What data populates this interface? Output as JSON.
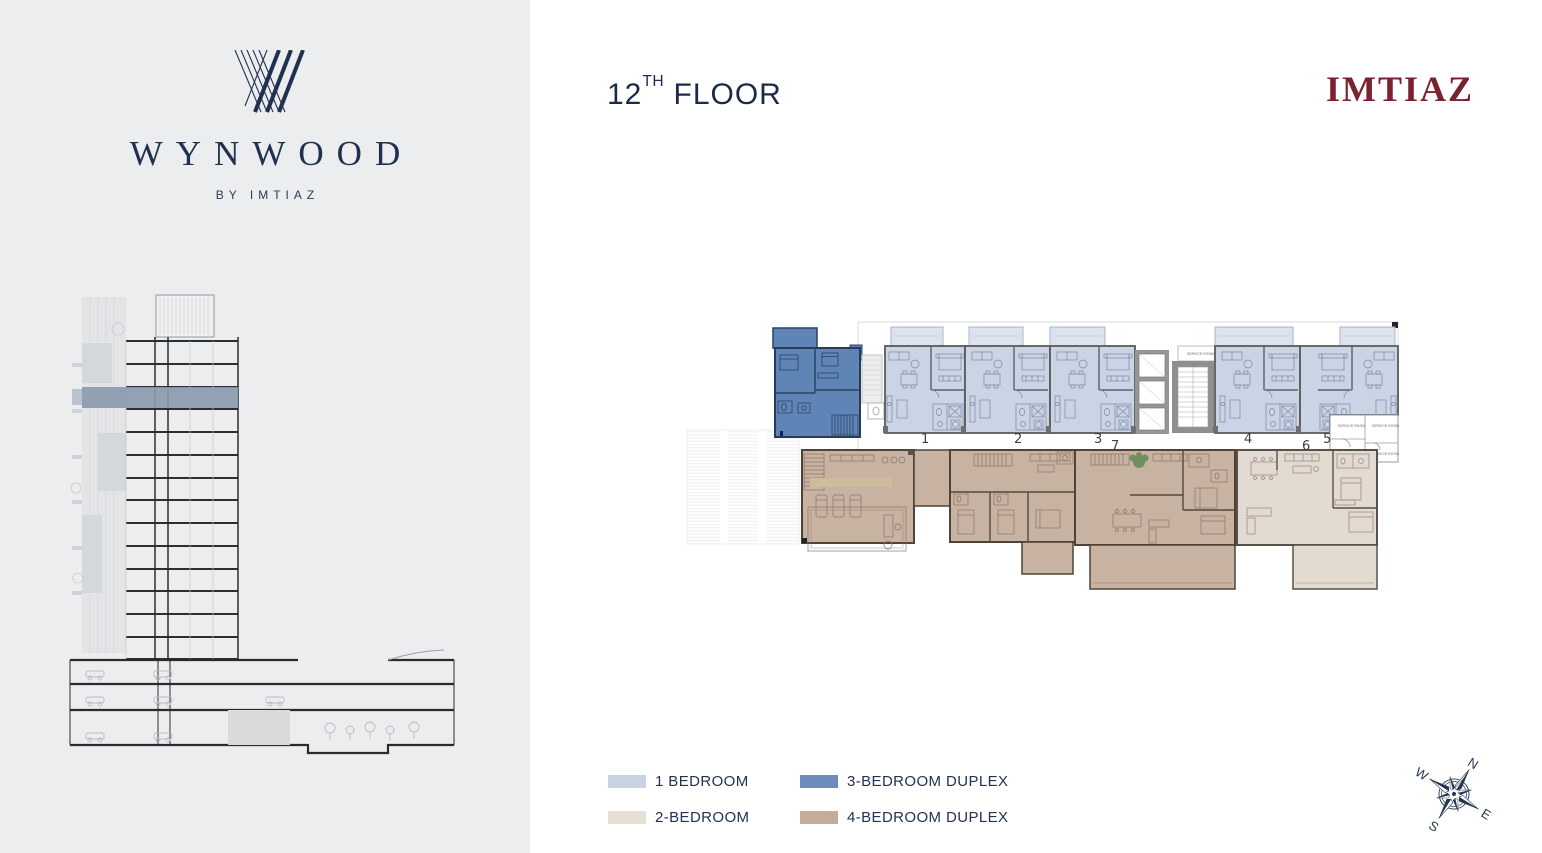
{
  "brand_panel": {
    "logo_word": "WYNWOOD",
    "logo_byline": "BY IMTIAZ"
  },
  "header": {
    "floor_main": "12",
    "floor_sup": "TH",
    "floor_rest": " FLOOR",
    "brand_logo": "IMTIAZ"
  },
  "floor_plan": {
    "unit_labels": [
      {
        "id": "unit-1",
        "label": "1"
      },
      {
        "id": "unit-2",
        "label": "2"
      },
      {
        "id": "unit-3",
        "label": "3"
      },
      {
        "id": "unit-4",
        "label": "4"
      },
      {
        "id": "unit-5",
        "label": "5"
      },
      {
        "id": "unit-6",
        "label": "6"
      },
      {
        "id": "unit-7",
        "label": "7"
      }
    ],
    "service_room_label": "SERVICE ROOM"
  },
  "legend": {
    "items": [
      {
        "key": "one-bedroom",
        "label": "1 BEDROOM",
        "color": "#c9d2e2"
      },
      {
        "key": "two-bedroom",
        "label": "2-BEDROOM",
        "color": "#e7ded4"
      },
      {
        "key": "three-bedroom-duplex",
        "label": "3-BEDROOM DUPLEX",
        "color": "#6d8cbc"
      },
      {
        "key": "four-bedroom-duplex",
        "label": "4-BEDROOM DUPLEX",
        "color": "#c5ac99"
      }
    ]
  },
  "compass": {
    "north": "N",
    "east": "E",
    "south": "S",
    "west": "W"
  },
  "colors": {
    "navy": "#1b2a49",
    "maroon": "#7b2130",
    "sidebar_bg": "#ecedef",
    "unit_1br": "#cbd4e4",
    "unit_1br_balcony": "#dce3ee",
    "unit_2br": "#e3dad1",
    "unit_3br_duplex": "#5f84b6",
    "unit_4br_duplex": "#c8b2a2",
    "section_highlight": "#8b9ab0"
  }
}
